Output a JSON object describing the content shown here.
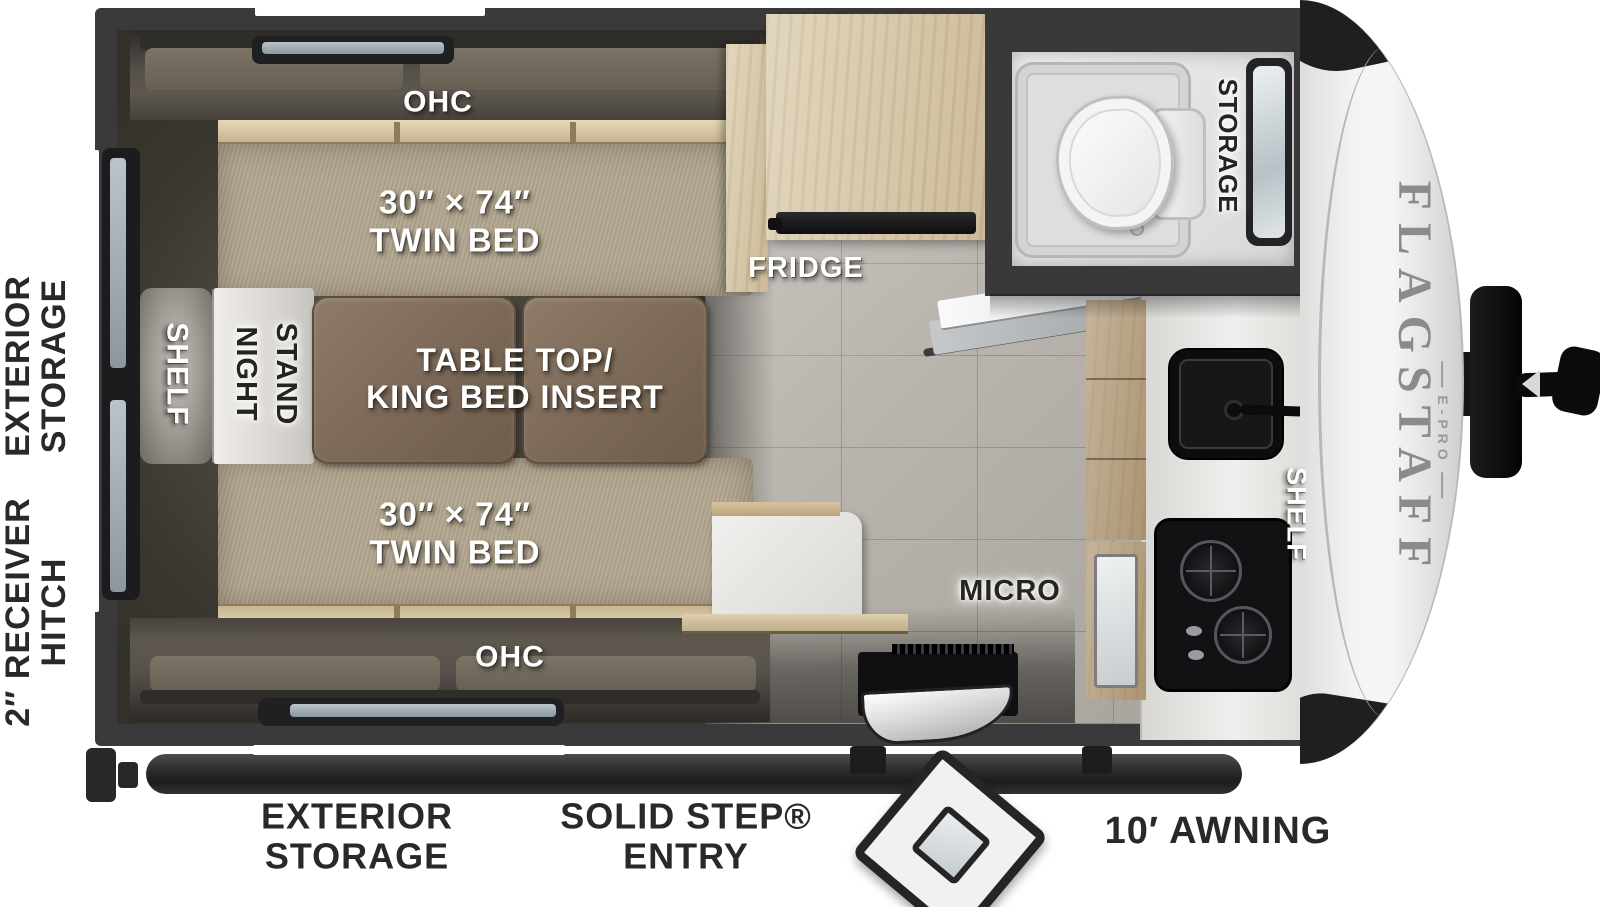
{
  "plan": {
    "bedroom": {
      "ohc_top": "OHC",
      "ohc_bottom": "OHC",
      "twin_bed_top": "30″ × 74″\nTWIN BED",
      "twin_bed_bottom": "30″ × 74″\nTWIN BED",
      "table": "TABLE TOP/\nKING BED INSERT",
      "shelf": "SHELF",
      "night_word": "NIGHT",
      "stand_word": "STAND"
    },
    "kitchen": {
      "fridge": "FRIDGE",
      "micro": "MICRO",
      "shelf": "SHELF"
    },
    "bathroom": {
      "storage": "STORAGE"
    }
  },
  "exterior": {
    "side_storage": "EXTERIOR\nSTORAGE",
    "hitch": "2″ RECEIVER\nHITCH",
    "bottom_storage": "EXTERIOR\nSTORAGE",
    "entry": "SOLID STEP®\nENTRY",
    "awning": "10′ AWNING"
  },
  "branding": {
    "model": "FLAGSTAFF",
    "series": "E-PRO"
  },
  "colors": {
    "wall": "#3a3a3c",
    "bed_fabric": "#b2a68f",
    "cushion": "#6f685c",
    "wood_light": "#d8c9a8",
    "table_top": "#7e6b5b",
    "floor_tile": "#b8b4ad",
    "counter": "#e7e6e4",
    "appliance_black": "#141416",
    "cap_white": "#f2f2f1",
    "brand_gray": "#8b8b89",
    "marker_red": "#b14a32"
  }
}
